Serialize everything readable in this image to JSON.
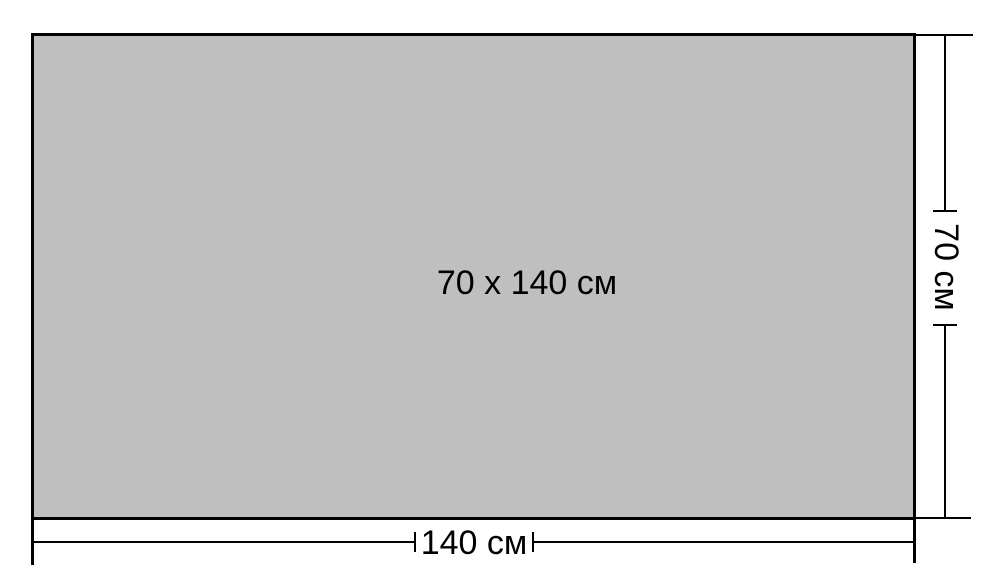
{
  "diagram": {
    "center_label": "70 x 140 см",
    "width_dimension": {
      "label": "140 см",
      "value_cm": 140
    },
    "height_dimension": {
      "label": "70 см",
      "value_cm": 70
    },
    "colors": {
      "rect_fill": "#bfbfbf",
      "line": "#000000",
      "background": "#ffffff"
    }
  }
}
